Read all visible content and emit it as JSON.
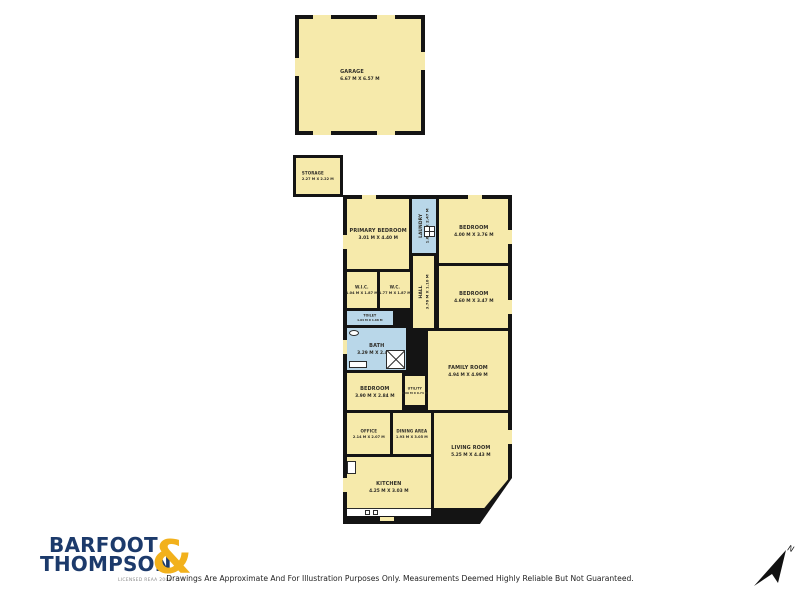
{
  "meta": {
    "kind": "real-estate floor plan"
  },
  "rooms": [
    {
      "name": "GARAGE",
      "dims": "6.67 M X 6.57 M"
    },
    {
      "name": "STORAGE",
      "dims": "2.27 M X 2.22 M"
    },
    {
      "name": "PRIMARY BEDROOM",
      "dims": "3.01 M X 4.40 M"
    },
    {
      "name": "LAUNDRY",
      "dims": "1.65 M X 2.47 M"
    },
    {
      "name": "BEDROOM",
      "dims": "4.00 M X 3.76 M"
    },
    {
      "name": "W.I.C.",
      "dims": "1.04 M X 1.87 M"
    },
    {
      "name": "W.C.",
      "dims": "1.77 M X 1.87 M"
    },
    {
      "name": "HALL",
      "dims": "3.76 M X 1.10 M"
    },
    {
      "name": "BEDROOM",
      "dims": "4.60 M X 3.47 M"
    },
    {
      "name": "TOILET",
      "dims": "1.04 M X 1.68 M"
    },
    {
      "name": "BATH",
      "dims": "3.29 M X 2.45 M"
    },
    {
      "name": "BEDROOM",
      "dims": "3.90 M X 2.84 M"
    },
    {
      "name": "FAMILY ROOM",
      "dims": "4.94 M X 4.99 M"
    },
    {
      "name": "UTILITY",
      "dims": "0.60 M X 0.74 M"
    },
    {
      "name": "OFFICE",
      "dims": "2.14 M X 2.07 M"
    },
    {
      "name": "DINING AREA",
      "dims": "1.93 M X 3.05 M"
    },
    {
      "name": "LIVING ROOM",
      "dims": "5.25 M X 4.43 M"
    },
    {
      "name": "KITCHEN",
      "dims": "4.25 M X 3.03 M"
    }
  ],
  "logo": {
    "brand_top": "BARFOOT",
    "brand_bottom": "THOMPSON",
    "ampersand": "&",
    "license": "LICENSED REAA 2008"
  },
  "footer": {
    "disclaimer": "Drawings Are Approximate And For Illustration Purposes Only. Measurements Deemed Highly Reliable But Not Guaranteed."
  },
  "compass": {
    "label": "N"
  },
  "colors": {
    "room_fill": "#F6EAAB",
    "wet_room_fill": "#B9D7E9",
    "wall": "#141414",
    "logo_blue": "#1C3A6B",
    "logo_gold": "#F2B11C"
  },
  "icons": {
    "north_arrow": "northeast-arrow",
    "shower": "crossed-square",
    "toilet": "oval-fixture",
    "washer": "grid-square"
  }
}
